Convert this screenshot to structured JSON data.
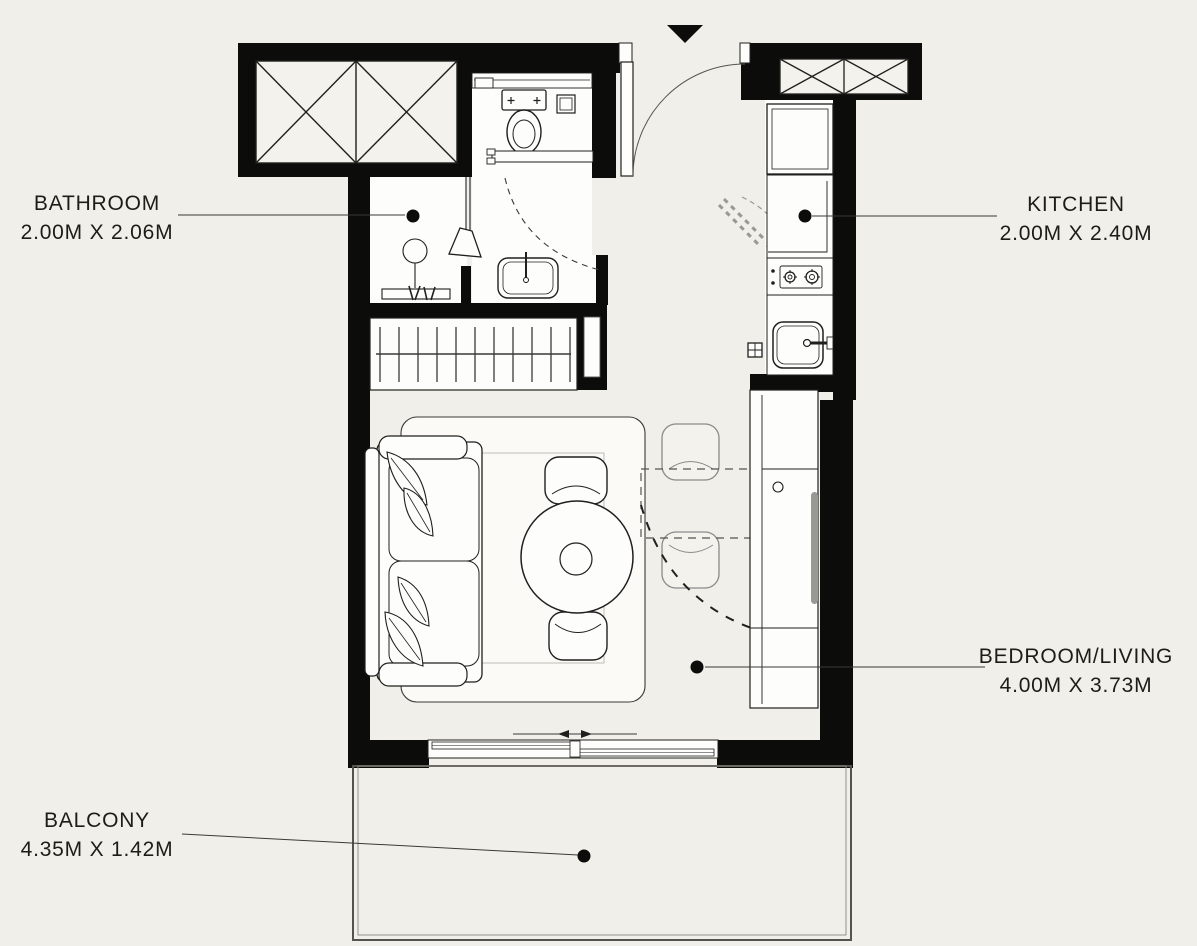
{
  "title": "Studio apartment floor plan",
  "rooms": [
    {
      "id": "bathroom",
      "name": "BATHROOM",
      "dimensions": "2.00M X 2.06M"
    },
    {
      "id": "kitchen",
      "name": "KITCHEN",
      "dimensions": "2.00M X 2.40M"
    },
    {
      "id": "bedroom_living",
      "name": "BEDROOM/LIVING",
      "dimensions": "4.00M X 3.73M"
    },
    {
      "id": "balcony",
      "name": "BALCONY",
      "dimensions": "4.35M X 1.42M"
    }
  ],
  "icons": {
    "entrance_marker": "filled-triangle-down",
    "room_marker": "filled-circle",
    "shaft_symbol": "crossed-box"
  },
  "colors": {
    "background": "#f1efe9",
    "walls": "#0c0c0a",
    "lines": "#1f1f1d",
    "fixture_fill": "#fdfdfb",
    "text": "#1d1c18",
    "muted_line": "#8a8a8a"
  }
}
